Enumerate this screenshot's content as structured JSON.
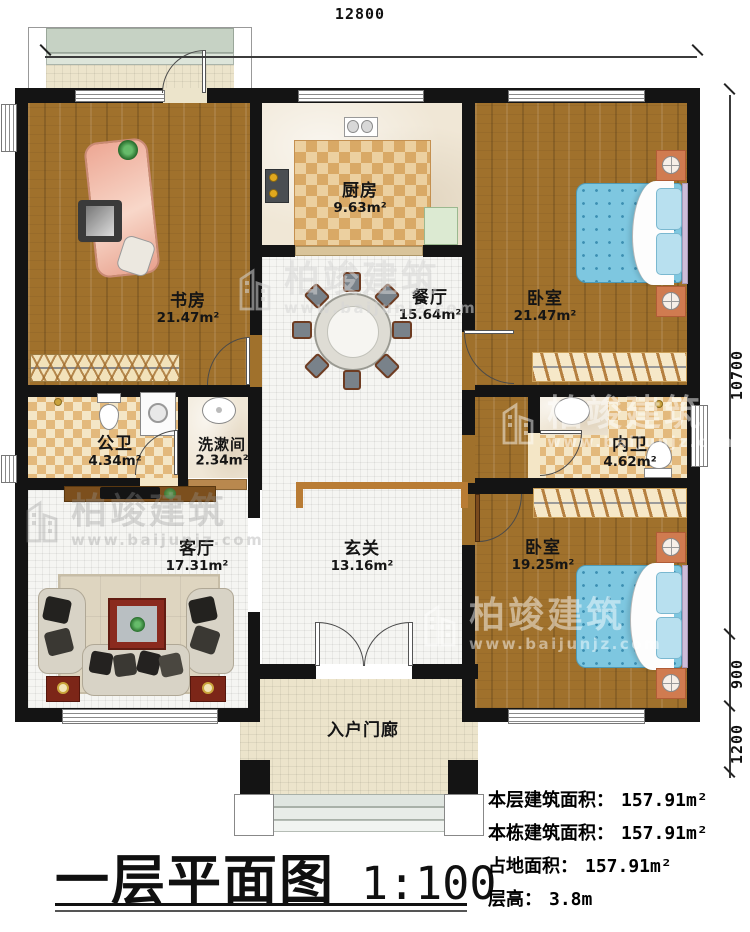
{
  "dimensions": {
    "width_top": "12800",
    "height_main": "10700",
    "height_step": "900",
    "height_porch": "1200"
  },
  "rooms": {
    "study": {
      "name": "书房",
      "area": "21.47m²"
    },
    "kitchen": {
      "name": "厨房",
      "area": "9.63m²"
    },
    "dining": {
      "name": "餐厅",
      "area": "15.64m²"
    },
    "bedroom1": {
      "name": "卧室",
      "area": "21.47m²"
    },
    "public_bath": {
      "name": "公卫",
      "area": "4.34m²"
    },
    "washroom": {
      "name": "洗漱间",
      "area": "2.34m²"
    },
    "private_bath": {
      "name": "内卫",
      "area": "4.62m²"
    },
    "living": {
      "name": "客厅",
      "area": "17.31m²"
    },
    "foyer": {
      "name": "玄关",
      "area": "13.16m²"
    },
    "bedroom2": {
      "name": "卧室",
      "area": "19.25m²"
    },
    "porch": {
      "name": "入户门廊"
    }
  },
  "title": {
    "name": "一层平面图",
    "scale": "1:100"
  },
  "stats": {
    "floor_area_label": "本层建筑面积：",
    "floor_area_value": "157.91m²",
    "building_area_label": "本栋建筑面积：",
    "building_area_value": "157.91m²",
    "land_area_label": "占地面积：",
    "land_area_value": "157.91m²",
    "height_label": "层高：",
    "height_value": "3.8m"
  },
  "watermark": {
    "brand": "柏竣建筑",
    "site": "www.baijunjz.com"
  }
}
